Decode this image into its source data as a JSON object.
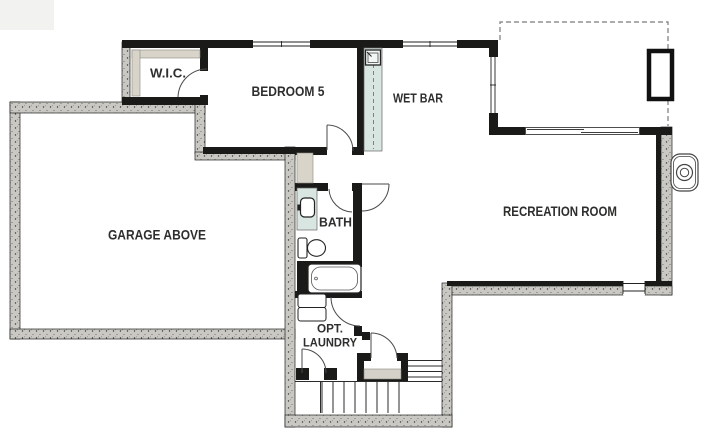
{
  "floor_plan": {
    "rooms": {
      "wic": "W.I.C.",
      "bedroom5": "BEDROOM 5",
      "wet_bar": "WET BAR",
      "garage": "GARAGE ABOVE",
      "bath": "BATH",
      "recreation": "RECREATION ROOM",
      "laundry_line1": "OPT.",
      "laundry_line2": "LAUNDRY"
    },
    "colors": {
      "wall": "#1a1a18",
      "foundation": "#c9c8c2",
      "counter": "#d9e5e0",
      "shelf": "#d8d4c9",
      "landing": "#d5d1c8",
      "background": "#ffffff"
    },
    "symbols": [
      "bathtub",
      "toilet",
      "vanity-sink",
      "wet-bar-sink",
      "washer-dryer",
      "stairs",
      "door-swing",
      "window",
      "sliding-door",
      "window-well",
      "sump-circle",
      "patio-dashed-outline",
      "closet-shelving"
    ]
  }
}
